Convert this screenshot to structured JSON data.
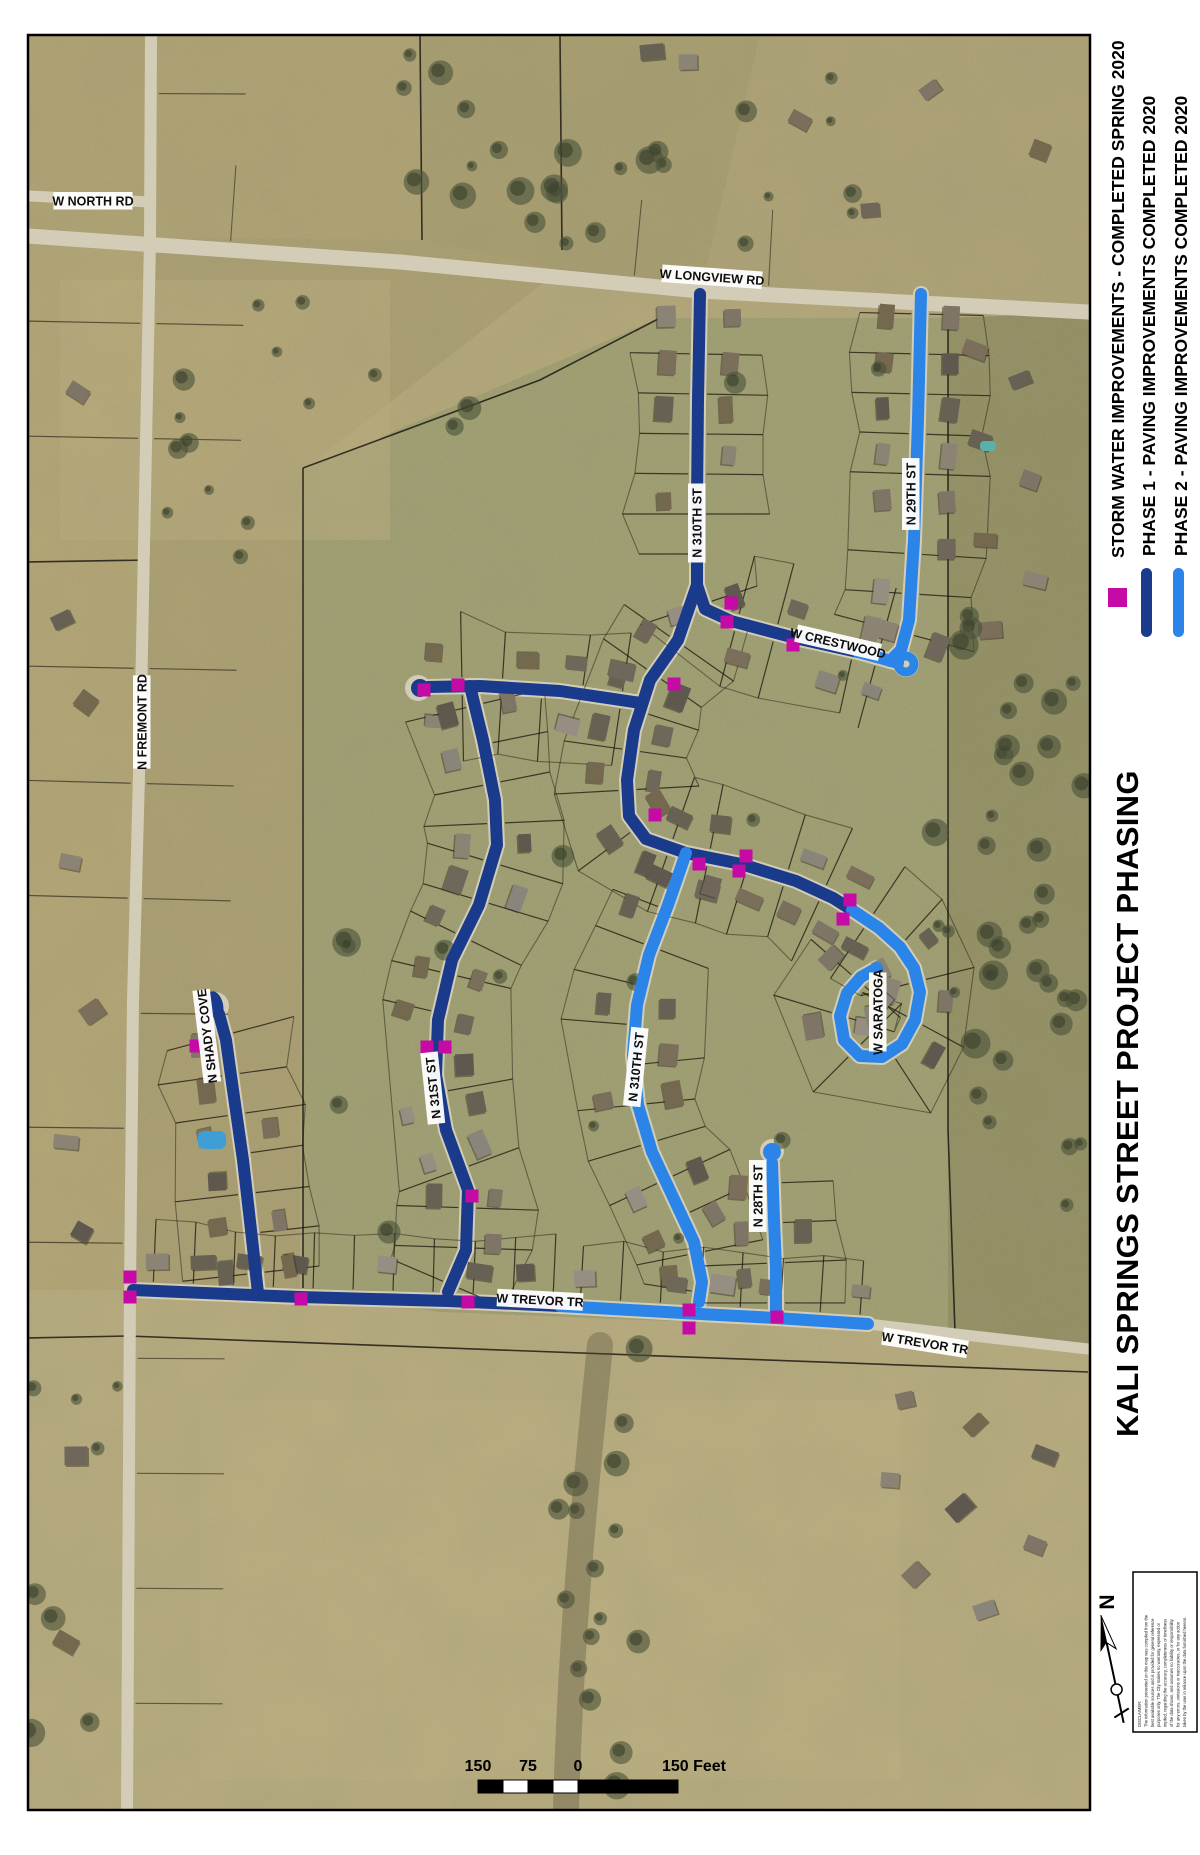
{
  "title": "KALI SPRINGS STREET PROJECT PHASING",
  "north_arrow_label": "N",
  "colors": {
    "phase1": "#1a3a8c",
    "phase2": "#2b85e8",
    "storm": "#c50aa5",
    "road_gray": "#d3cdb7",
    "label_bg": "#ffffff",
    "label_text": "#0d0d0d"
  },
  "legend": {
    "items": [
      {
        "label": "STORM WATER IMPROVEMENTS - COMPLETED SPRING 2020",
        "symbol": "square",
        "color": "#c50aa5"
      },
      {
        "label": "PHASE 1 - PAVING IMPROVEMENTS COMPLETED 2020",
        "symbol": "line",
        "color": "#1a3a8c"
      },
      {
        "label": "PHASE 2 - PAVING IMPROVEMENTS COMPLETED 2020",
        "symbol": "line",
        "color": "#2b85e8"
      }
    ]
  },
  "street_labels": [
    {
      "text": "W NORTH RD",
      "x": 93,
      "y": 201,
      "rot": 0
    },
    {
      "text": "W LONGVIEW RD",
      "x": 712,
      "y": 277,
      "rot": 4
    },
    {
      "text": "N FREMONT RD",
      "x": 142,
      "y": 722,
      "rot": -90
    },
    {
      "text": "N 310TH ST",
      "x": 697,
      "y": 523,
      "rot": -90
    },
    {
      "text": "W CRESTWOOD",
      "x": 838,
      "y": 643,
      "rot": 13
    },
    {
      "text": "N 29TH ST",
      "x": 911,
      "y": 494,
      "rot": -90
    },
    {
      "text": "N 310TH ST",
      "x": 636,
      "y": 1067,
      "rot": -84
    },
    {
      "text": "N 31ST ST",
      "x": 433,
      "y": 1088,
      "rot": -96
    },
    {
      "text": "W SARATOGA",
      "x": 878,
      "y": 1012,
      "rot": -90
    },
    {
      "text": "N SHADY COVE",
      "x": 207,
      "y": 1036,
      "rot": -97
    },
    {
      "text": "W TREVOR TR",
      "x": 540,
      "y": 1300,
      "rot": 3
    },
    {
      "text": "W TREVOR TR",
      "x": 925,
      "y": 1343,
      "rot": 9
    },
    {
      "text": "N 28TH ST",
      "x": 758,
      "y": 1196,
      "rot": -90
    }
  ],
  "storm_water_squares": [
    [
      731,
      603
    ],
    [
      727,
      622
    ],
    [
      793,
      645
    ],
    [
      674,
      684
    ],
    [
      424,
      690
    ],
    [
      458,
      685
    ],
    [
      655,
      815
    ],
    [
      699,
      864
    ],
    [
      746,
      856
    ],
    [
      739,
      871
    ],
    [
      850,
      900
    ],
    [
      843,
      919
    ],
    [
      427,
      1047
    ],
    [
      445,
      1047
    ],
    [
      472,
      1196
    ],
    [
      196,
      1046
    ],
    [
      130,
      1277
    ],
    [
      130,
      1297
    ],
    [
      301,
      1299
    ],
    [
      468,
      1302
    ],
    [
      557,
      1303
    ],
    [
      689,
      1310
    ],
    [
      689,
      1328
    ],
    [
      777,
      1317
    ]
  ],
  "scale_bar": {
    "left_label": "150",
    "mid_label": "75",
    "zero_label": "0",
    "right_label": "150 Feet"
  },
  "disclaimer_lines": [
    "DISCLAIMER:",
    "The information presented on this map was compiled from the",
    "best available sources and is provided for general reference",
    "purposes only. The City makes no warranty, expressed or",
    "implied, regarding the accuracy, completeness or timeliness",
    "of the data shown, and assumes no liability or responsibility",
    "for any errors, omissions or inaccuracies, or for any action",
    "taken by the user in reliance upon the data furnished hereon."
  ]
}
